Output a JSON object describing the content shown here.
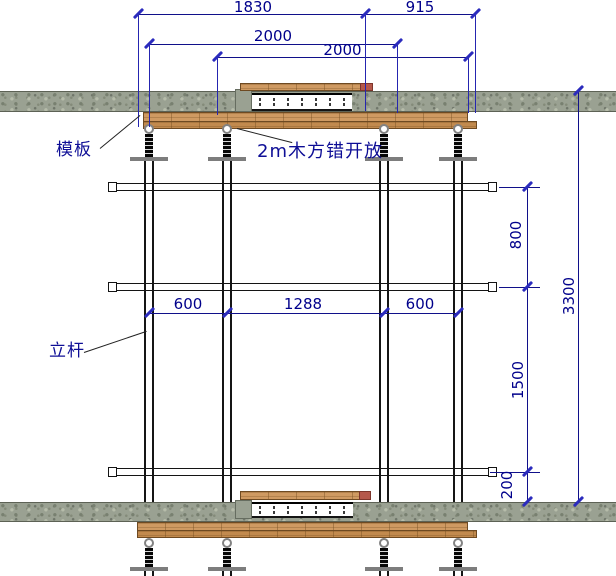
{
  "labels": {
    "formwork": "模板",
    "wood_note": "2m木方错开放",
    "pole": "立杆"
  },
  "dimensions": {
    "span_1830": "1830",
    "span_915": "915",
    "span_2000_a": "2000",
    "span_2000_b": "2000",
    "spacing_600_left": "600",
    "spacing_1288": "1288",
    "spacing_600_right": "600",
    "step_800": "800",
    "step_1500": "1500",
    "step_200": "200",
    "total_3300": "3300"
  },
  "colors": {
    "dimension_line": "#10108a",
    "dimension_tick": "#2b2bbd",
    "label_text": "#0e0e96",
    "concrete_slab": "#9aa192",
    "timber": "#cf9a62",
    "jack_plate": "#7d7d7d"
  }
}
